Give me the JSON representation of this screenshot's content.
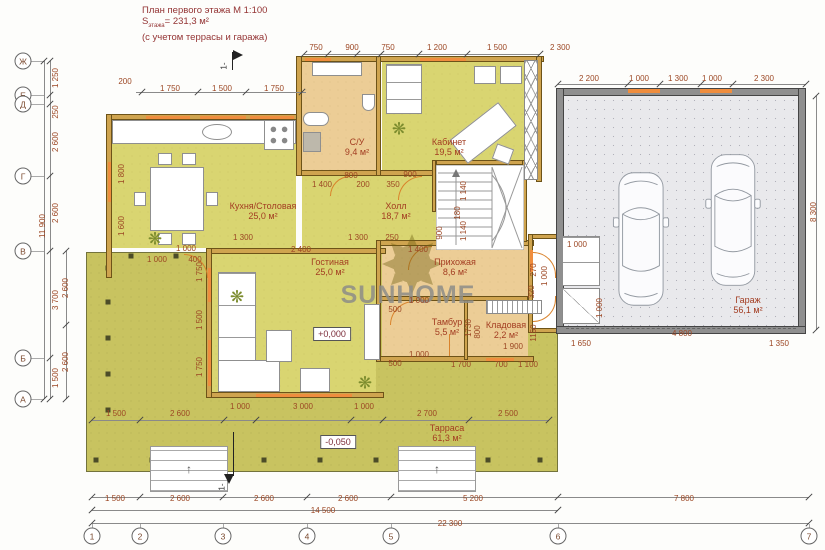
{
  "title": {
    "line1": "План первого этажа   М 1:100",
    "s_prefix": "S",
    "s_sub": "этажа",
    "s_suffix": "= 231,3 м²",
    "line3": "(с учетом террасы и гаража)"
  },
  "watermark": {
    "text": "SUNHOME"
  },
  "markers": {
    "elev_main": "+0,000",
    "elev_terrace": "-0,050",
    "section": "1-"
  },
  "icons": {
    "plant": "❋",
    "stair_arrow": "↑"
  },
  "colors": {
    "room_yellow": "#d9d571",
    "room_tan": "#eccd96",
    "terrace": "#c8c360",
    "timber_wall": "#cfa44f",
    "garage_wall": "#8f8f8f",
    "window": "#ef8d3e",
    "dim_text": "#9c4724",
    "label_text": "#a33d22",
    "title_text": "#943434"
  },
  "axes": {
    "rows": [
      {
        "label": "Ж",
        "y": 61
      },
      {
        "label": "Е",
        "y": 95
      },
      {
        "label": "Д",
        "y": 104
      },
      {
        "label": "Г",
        "y": 176
      },
      {
        "label": "В",
        "y": 251
      },
      {
        "label": "Б",
        "y": 358
      },
      {
        "label": "А",
        "y": 399
      }
    ],
    "cols": [
      {
        "label": "1",
        "x": 92
      },
      {
        "label": "2",
        "x": 140
      },
      {
        "label": "3",
        "x": 223
      },
      {
        "label": "4",
        "x": 307
      },
      {
        "label": "5",
        "x": 391
      },
      {
        "label": "6",
        "x": 558
      },
      {
        "label": "7",
        "x": 809
      }
    ]
  },
  "rooms": [
    {
      "name": "Кухня/Столовая",
      "area": "25,0 м²",
      "x": 263,
      "y": 211
    },
    {
      "name": "С/У",
      "area": "9,4 м²",
      "x": 357,
      "y": 147
    },
    {
      "name": "Кабинет",
      "area": "19,5 м²",
      "x": 449,
      "y": 147
    },
    {
      "name": "Холл",
      "area": "18,7 м²",
      "x": 396,
      "y": 211
    },
    {
      "name": "Гостиная",
      "area": "25,0 м²",
      "x": 330,
      "y": 267
    },
    {
      "name": "Прихожая",
      "area": "8,6 м²",
      "x": 455,
      "y": 267
    },
    {
      "name": "Тамбур",
      "area": "5,5 м²",
      "x": 447,
      "y": 327
    },
    {
      "name": "Кладовая",
      "area": "2,2 м²",
      "x": 506,
      "y": 330
    },
    {
      "name": "Гараж",
      "area": "56,1 м²",
      "x": 748,
      "y": 305
    },
    {
      "name": "Тарраса",
      "area": "61,3 м²",
      "x": 447,
      "y": 433
    }
  ],
  "dims": [
    [
      "750",
      316,
      48
    ],
    [
      "900",
      352,
      48
    ],
    [
      "750",
      388,
      48
    ],
    [
      "1 200",
      437,
      48
    ],
    [
      "1 500",
      497,
      48
    ],
    [
      "2 300",
      560,
      48
    ],
    [
      "2 200",
      589,
      79
    ],
    [
      "1 000",
      639,
      79
    ],
    [
      "1 300",
      678,
      79
    ],
    [
      "1 000",
      712,
      79
    ],
    [
      "2 300",
      764,
      79
    ],
    [
      "200",
      125,
      82
    ],
    [
      "1 750",
      170,
      89
    ],
    [
      "1 500",
      222,
      89
    ],
    [
      "1 750",
      274,
      89
    ],
    [
      "1 250",
      56,
      78,
      1
    ],
    [
      "250",
      56,
      112,
      1
    ],
    [
      "2 600",
      56,
      142,
      1
    ],
    [
      "2 600",
      56,
      213,
      1
    ],
    [
      "11 900",
      43,
      226,
      1
    ],
    [
      "3 700",
      56,
      300,
      1
    ],
    [
      "2 600",
      66,
      288,
      1
    ],
    [
      "1 500",
      56,
      378,
      1
    ],
    [
      "2 600",
      66,
      362,
      1
    ],
    [
      "1 800",
      122,
      174,
      1
    ],
    [
      "1 600",
      122,
      226,
      1
    ],
    [
      "1 750",
      200,
      272,
      1
    ],
    [
      "1 500",
      200,
      320,
      1
    ],
    [
      "1 750",
      200,
      367,
      1
    ],
    [
      "800",
      351,
      176
    ],
    [
      "900",
      410,
      175
    ],
    [
      "1 400",
      322,
      185
    ],
    [
      "200",
      363,
      185
    ],
    [
      "350",
      393,
      185
    ],
    [
      "1 300",
      243,
      238
    ],
    [
      "1 300",
      358,
      238
    ],
    [
      "250",
      392,
      238
    ],
    [
      "1 000",
      186,
      249
    ],
    [
      "2 400",
      301,
      250
    ],
    [
      "1 400",
      418,
      250
    ],
    [
      "1 000",
      157,
      260
    ],
    [
      "400",
      195,
      260
    ],
    [
      "1 140",
      464,
      191,
      1
    ],
    [
      "180",
      458,
      213,
      1
    ],
    [
      "1 140",
      464,
      231,
      1
    ],
    [
      "900",
      440,
      233,
      1
    ],
    [
      "1 000",
      577,
      245
    ],
    [
      "270",
      534,
      270,
      1
    ],
    [
      "1 000",
      545,
      276,
      1
    ],
    [
      "320",
      532,
      292,
      1
    ],
    [
      "1 000",
      600,
      308,
      1
    ],
    [
      "1150",
      534,
      333,
      1
    ],
    [
      "1 650",
      581,
      344
    ],
    [
      "1 350",
      779,
      344
    ],
    [
      "4 800",
      682,
      334
    ],
    [
      "8 300",
      814,
      212,
      1
    ],
    [
      "500",
      395,
      310
    ],
    [
      "1 000",
      419,
      301
    ],
    [
      "500",
      395,
      364
    ],
    [
      "1 000",
      419,
      355
    ],
    [
      "1 700",
      461,
      365
    ],
    [
      "700",
      501,
      365
    ],
    [
      "1 100",
      528,
      365
    ],
    [
      "1730",
      469,
      328,
      1
    ],
    [
      "800",
      478,
      332,
      1
    ],
    [
      "1 900",
      513,
      347
    ],
    [
      "1 000",
      240,
      407
    ],
    [
      "3 000",
      303,
      407
    ],
    [
      "1 000",
      364,
      407
    ],
    [
      "1 500",
      116,
      414
    ],
    [
      "2 600",
      180,
      414
    ],
    [
      "2 700",
      427,
      414
    ],
    [
      "2 500",
      508,
      414
    ],
    [
      "1 500",
      115,
      499
    ],
    [
      "2 600",
      180,
      499
    ],
    [
      "2 600",
      264,
      499
    ],
    [
      "2 600",
      348,
      499
    ],
    [
      "5 200",
      473,
      499
    ],
    [
      "7 800",
      684,
      499
    ],
    [
      "14 500",
      323,
      511
    ],
    [
      "22 300",
      450,
      524
    ]
  ],
  "rails": [
    {
      "x1": 92,
      "x2": 809,
      "y": 497,
      "ticks": [
        92,
        140,
        223,
        307,
        391,
        558,
        809
      ]
    },
    {
      "x1": 92,
      "x2": 558,
      "y": 510,
      "ticks": [
        92,
        558
      ]
    },
    {
      "x1": 92,
      "x2": 809,
      "y": 523,
      "ticks": [
        92,
        809
      ]
    },
    {
      "x1": 92,
      "x2": 549,
      "y": 420,
      "ticks": [
        92,
        140,
        224,
        256,
        351,
        383,
        469,
        549
      ]
    },
    {
      "x1": 304,
      "x2": 540,
      "y": 54,
      "ticks": [
        304,
        328,
        357,
        381,
        419,
        467,
        540
      ]
    },
    {
      "x1": 136,
      "x2": 306,
      "y": 92,
      "ticks": [
        142,
        198,
        246,
        302
      ]
    },
    {
      "x1": 558,
      "x2": 806,
      "y": 84,
      "ticks": [
        558,
        628,
        660,
        701,
        733,
        806
      ]
    }
  ],
  "vrails": [
    {
      "y1": 61,
      "y2": 399,
      "x": 50,
      "ticks": [
        61,
        95,
        104,
        176,
        251,
        358,
        399
      ]
    },
    {
      "y1": 61,
      "y2": 399,
      "x": 44,
      "ticks": [
        61,
        399
      ]
    },
    {
      "y1": 251,
      "y2": 399,
      "x": 66,
      "ticks": [
        251,
        325,
        399
      ]
    },
    {
      "y1": 96,
      "y2": 330,
      "x": 816,
      "ticks": [
        96,
        330
      ]
    }
  ],
  "posts": [
    [
      108,
      268
    ],
    [
      108,
      302
    ],
    [
      108,
      338
    ],
    [
      108,
      374
    ],
    [
      108,
      410
    ],
    [
      96,
      460
    ],
    [
      152,
      460
    ],
    [
      208,
      460
    ],
    [
      264,
      460
    ],
    [
      320,
      460
    ],
    [
      376,
      460
    ],
    [
      432,
      460
    ],
    [
      488,
      460
    ],
    [
      540,
      460
    ],
    [
      131,
      256
    ],
    [
      176,
      256
    ]
  ],
  "plants": [
    [
      155,
      239
    ],
    [
      237,
      297
    ],
    [
      365,
      383
    ],
    [
      399,
      129
    ]
  ]
}
